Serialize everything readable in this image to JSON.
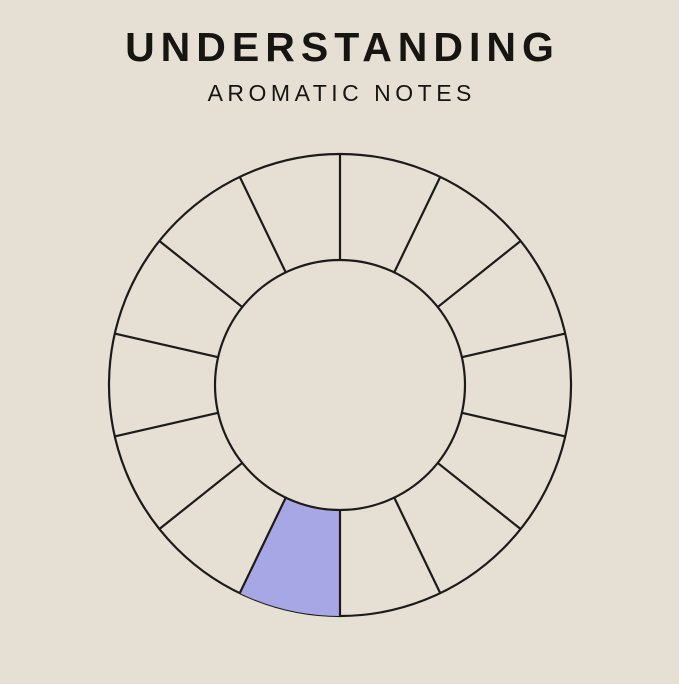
{
  "header": {
    "title": "UNDERSTANDING",
    "subtitle": "AROMATIC NOTES"
  },
  "wheel": {
    "type": "radial-category-wheel",
    "segment_count": 14,
    "highlighted_label": "Citrus",
    "segments": [
      {
        "label": "Soft Oriental",
        "lines": [
          "Soft",
          "Oriental"
        ],
        "highlighted": false
      },
      {
        "label": "Oriental",
        "lines": [
          "Oriental"
        ],
        "highlighted": false
      },
      {
        "label": "Woody Oriental",
        "lines": [
          "Woody",
          "Oriental"
        ],
        "highlighted": false
      },
      {
        "label": "Woody",
        "lines": [
          "Woody"
        ],
        "highlighted": false
      },
      {
        "label": "Mossy Wood",
        "lines": [
          "Mossy",
          "Wood"
        ],
        "highlighted": false
      },
      {
        "label": "Dry Wood",
        "lines": [
          "Dry",
          "Wood"
        ],
        "highlighted": false
      },
      {
        "label": "Aromatic",
        "lines": [
          "Aromatic"
        ],
        "highlighted": false
      },
      {
        "label": "Citrus",
        "lines": [
          "Citrus"
        ],
        "highlighted": true
      },
      {
        "label": "Water",
        "lines": [
          "Water"
        ],
        "highlighted": false
      },
      {
        "label": "Green",
        "lines": [
          "Green"
        ],
        "highlighted": false
      },
      {
        "label": "Fruity",
        "lines": [
          "Fruity"
        ],
        "highlighted": false
      },
      {
        "label": "Floral",
        "lines": [
          "Floral"
        ],
        "highlighted": false
      },
      {
        "label": "Soft Floral",
        "lines": [
          "Soft",
          "Floral"
        ],
        "highlighted": false
      },
      {
        "label": "Floral Oriental",
        "lines": [
          "Floral",
          "Oriental"
        ],
        "highlighted": false
      }
    ]
  },
  "bottle": {
    "brand_bold": "VINE",
    "brand_light": "VIDA",
    "scent_label": "SCENT NO. 48",
    "chip_label": "Fragrance Oil – For Diffusers",
    "watermark": "48"
  },
  "colors": {
    "background": "#e6dfd3",
    "line": "#1c1b19",
    "highlight": "#a8a7e6",
    "title_text": "#161512",
    "wheel_text": "#1d1c1a",
    "bottle_body": "#282420",
    "bottle_rim": "#6b5438",
    "bottle_label_bg": "#d6d2c9",
    "watermark_text": "#c8c4bb",
    "brand_bold_text": "#35332d",
    "brand_light_text": "#9b978e",
    "scent_text": "#53504a",
    "fine_print": "#a09c93",
    "chip_bg": "#16140e",
    "chip_text": "#efede6"
  }
}
